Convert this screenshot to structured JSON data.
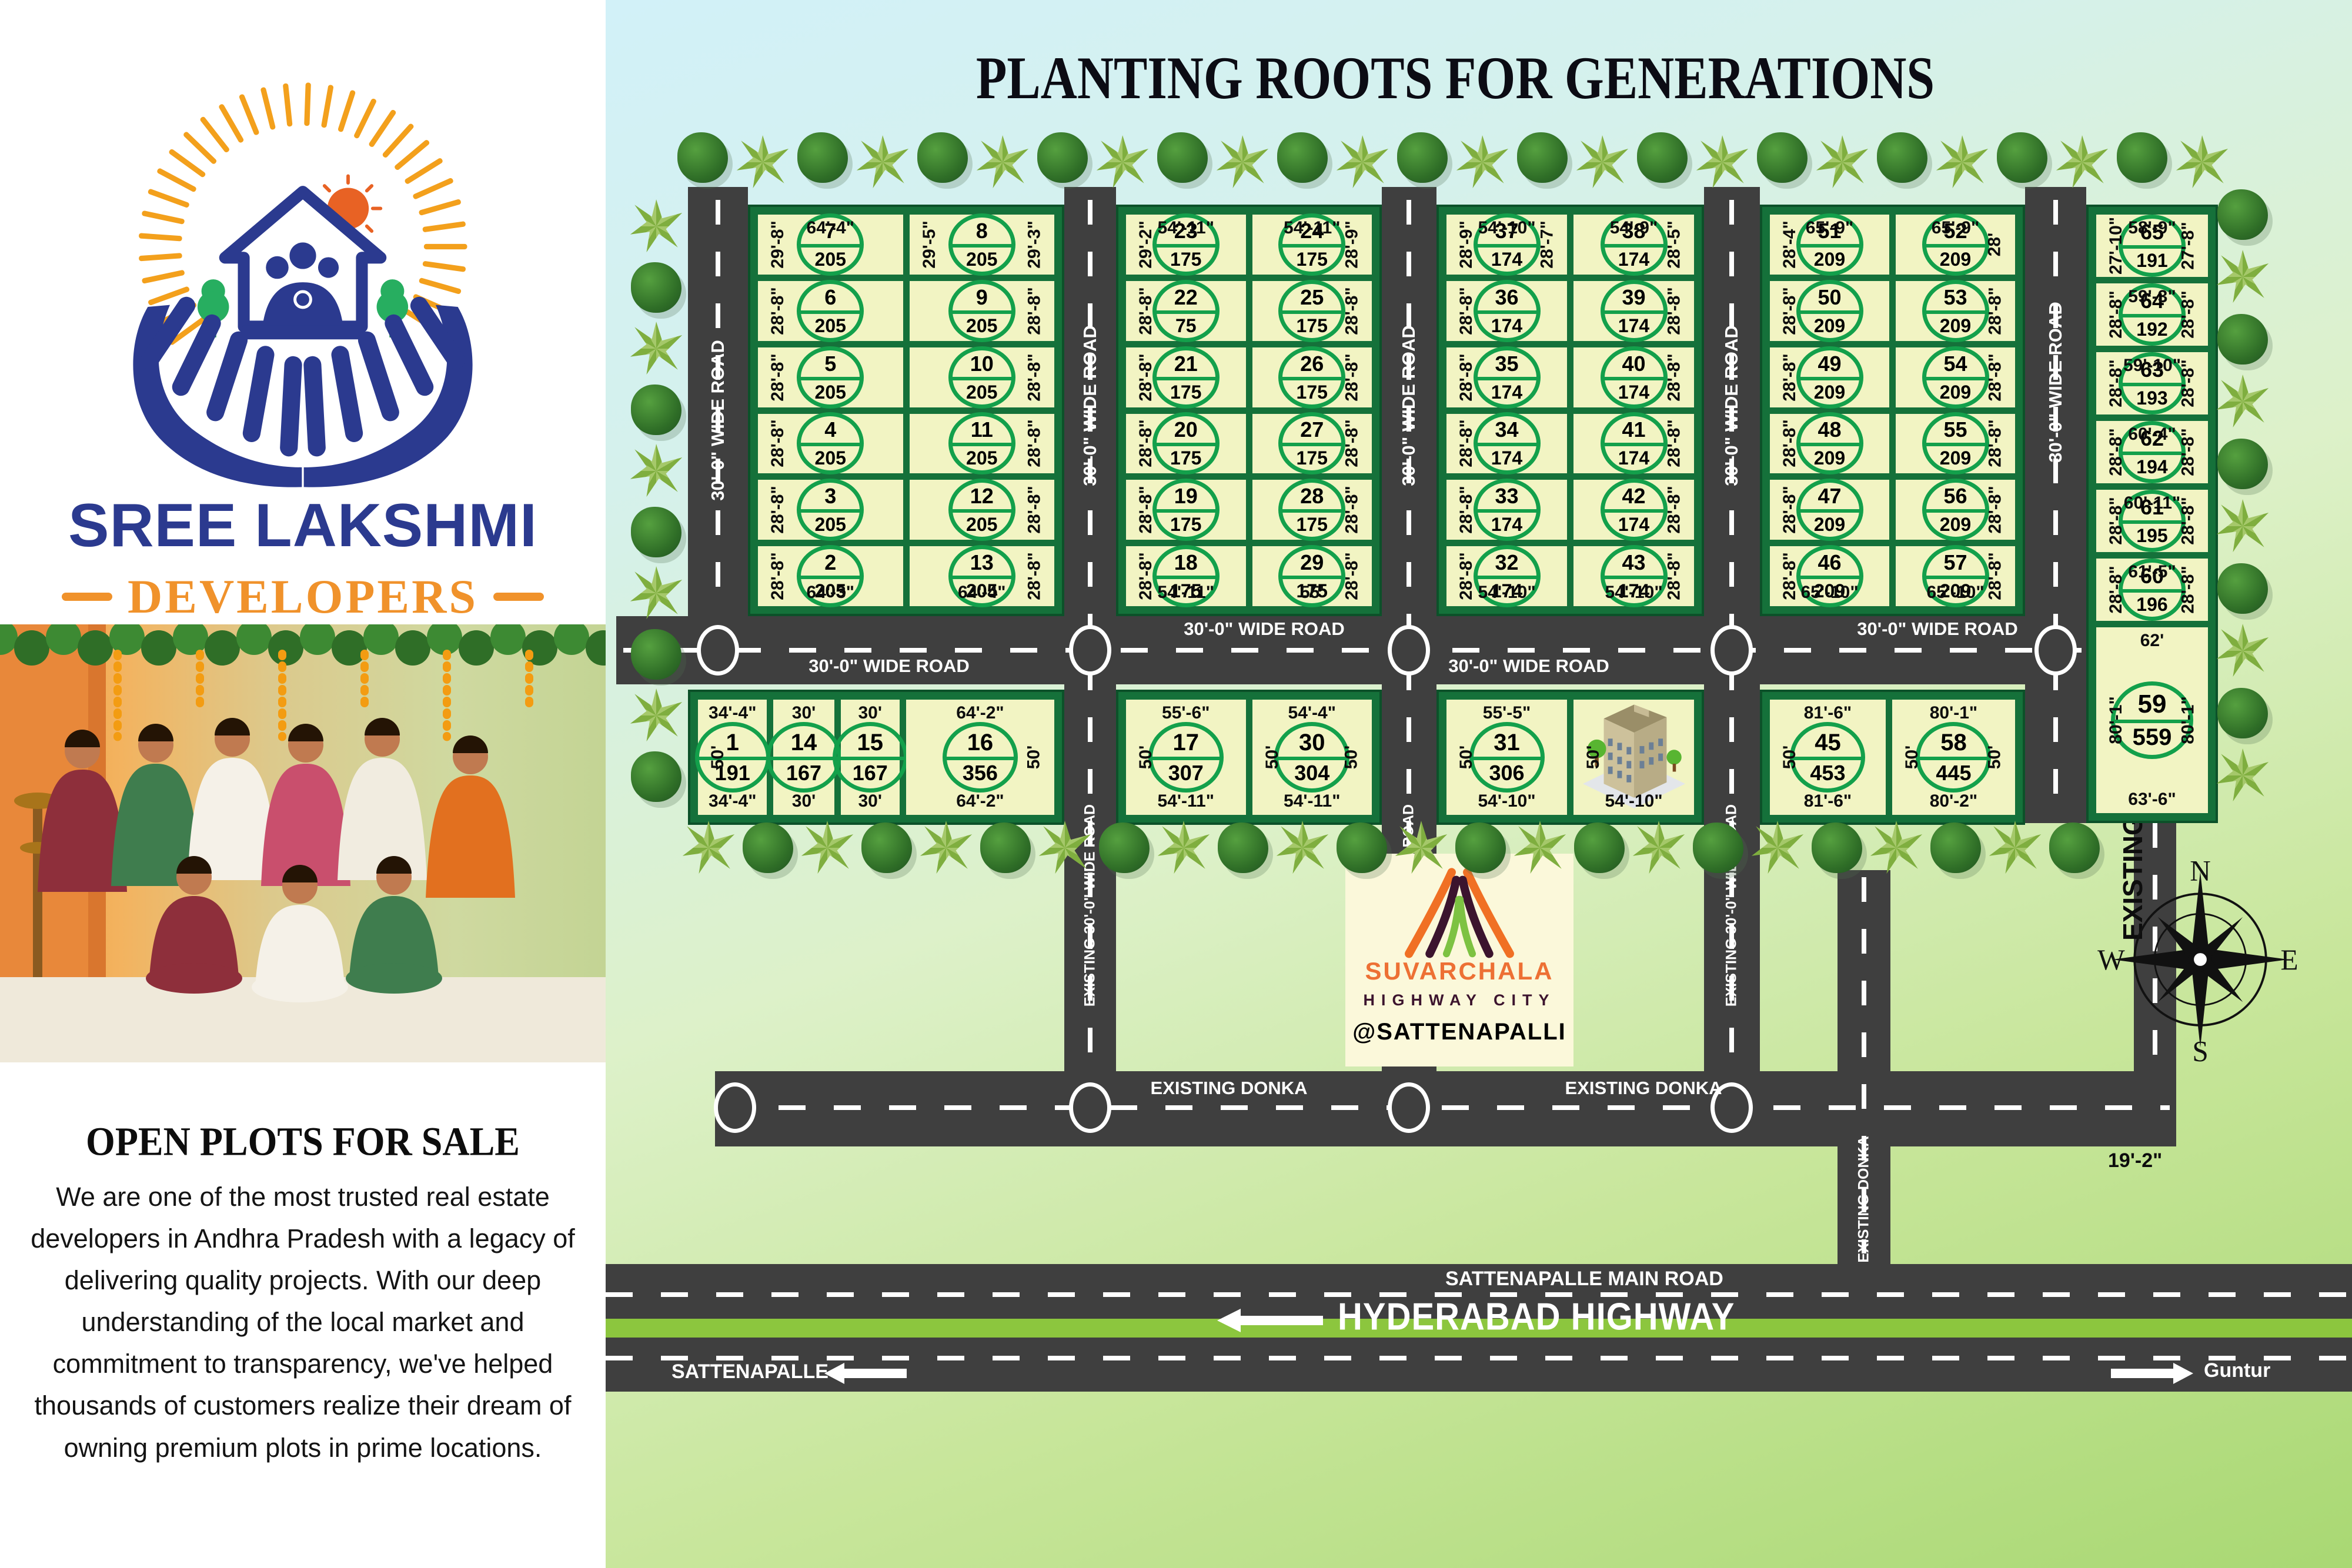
{
  "poster": {
    "title": "PLANTING ROOTS FOR GENERATIONS",
    "left_panel": {
      "brand_name": "SREE LAKSHMI",
      "brand_sub": "DEVELOPERS",
      "brand_tagline": "Planting Roots for Generations",
      "heading": "OPEN PLOTS FOR SALE",
      "paragraph": "We are one of the most trusted real estate developers in Andhra Pradesh with a legacy of delivering quality projects. With our deep understanding of the local market and commitment to transparency, we've helped thousands of customers realize their dream of owning premium plots in prime locations."
    },
    "site_card": {
      "name": "SUVARCHALA",
      "sub": "HIGHWAY CITY",
      "location": "@SATTENAPALLI"
    },
    "compass": {
      "north": "N",
      "south": "S",
      "east": "E",
      "west": "W"
    },
    "road_labels": {
      "wide_road": "30'-0\"  WIDE  ROAD",
      "existing_wide_road": "EXISTING 30'-0\" WIDE ROAD",
      "existing_donka": "EXISTING DONKA",
      "existing_houses": "EXISTING HOUSES",
      "main_road": "SATTENAPALLE MAIN ROAD",
      "highway": "HYDERABAD HIGHWAY",
      "left_city": "SATTENAPALLE",
      "right_city": "Guntur",
      "gap": "19'-2\""
    },
    "colors": {
      "road": "#3f3f3f",
      "block_border": "#15713a",
      "plot_fill": "#f2f4c3",
      "badge_green": "#13a04b",
      "highway_green": "#8cc63e",
      "brand_blue": "#2b3a8f",
      "brand_orange": "#f0922b"
    },
    "blocks": {
      "b1": {
        "plots": [
          {
            "no": "7",
            "area": "205",
            "l": "29'-8\"",
            "t": "64'-4\""
          },
          {
            "no": "8",
            "area": "205",
            "l": "29'-5\"",
            "r": "29'-3\""
          },
          {
            "no": "6",
            "area": "205",
            "l": "28'-8\""
          },
          {
            "no": "9",
            "area": "205",
            "r": "28'-8\""
          },
          {
            "no": "5",
            "area": "205",
            "l": "28'-8\""
          },
          {
            "no": "10",
            "area": "205",
            "r": "28'-8\""
          },
          {
            "no": "4",
            "area": "205",
            "l": "28'-8\""
          },
          {
            "no": "11",
            "area": "205",
            "r": "28'-8\""
          },
          {
            "no": "3",
            "area": "205",
            "l": "28'-8\""
          },
          {
            "no": "12",
            "area": "205",
            "r": "28'-8\""
          },
          {
            "no": "2",
            "area": "205",
            "l": "28'-8\"",
            "b": "64'-3\""
          },
          {
            "no": "13",
            "area": "205",
            "r": "28'-8\"",
            "b": "64'-4\""
          }
        ]
      },
      "b2": {
        "plots": [
          {
            "no": "23",
            "area": "175",
            "l": "29'-2\"",
            "t": "54'-11\""
          },
          {
            "no": "24",
            "area": "175",
            "t": "54'-11\"",
            "r": "28'-9\""
          },
          {
            "no": "22",
            "area": "75",
            "l": "28'-8\""
          },
          {
            "no": "25",
            "area": "175",
            "r": "28'-8\""
          },
          {
            "no": "21",
            "area": "175",
            "l": "28'-8\""
          },
          {
            "no": "26",
            "area": "175",
            "r": "28'-8\""
          },
          {
            "no": "20",
            "area": "175",
            "l": "28'-8\""
          },
          {
            "no": "27",
            "area": "175",
            "r": "28'-8\""
          },
          {
            "no": "19",
            "area": "175",
            "l": "28'-8\""
          },
          {
            "no": "28",
            "area": "175",
            "r": "28'-8\""
          },
          {
            "no": "18",
            "area": "175",
            "l": "28'-8\"",
            "b": "54'-11\""
          },
          {
            "no": "29",
            "area": "175",
            "b": "55'",
            "r": "28'-8\""
          }
        ]
      },
      "b3": {
        "plots": [
          {
            "no": "37",
            "area": "174",
            "l": "28'-9\"",
            "t": "54'-10\"",
            "r": "28'-7\""
          },
          {
            "no": "38",
            "area": "174",
            "t": "54'-9\"",
            "r": "28'-5\""
          },
          {
            "no": "36",
            "area": "174",
            "l": "28'-8\""
          },
          {
            "no": "39",
            "area": "174",
            "r": "28'-8\""
          },
          {
            "no": "35",
            "area": "174",
            "l": "28'-8\""
          },
          {
            "no": "40",
            "area": "174",
            "r": "28'-8\""
          },
          {
            "no": "34",
            "area": "174",
            "l": "28'-8\""
          },
          {
            "no": "41",
            "area": "174",
            "r": "28'-8\""
          },
          {
            "no": "33",
            "area": "174",
            "l": "28'-8\""
          },
          {
            "no": "42",
            "area": "174",
            "r": "28'-8\""
          },
          {
            "no": "32",
            "area": "174",
            "l": "28'-8\"",
            "b": "54'-10\""
          },
          {
            "no": "43",
            "area": "174",
            "b": "54'-10\"",
            "r": "28'-8\""
          }
        ]
      },
      "b4": {
        "plots": [
          {
            "no": "51",
            "area": "209",
            "l": "28'-4\"",
            "t": "65'-9\""
          },
          {
            "no": "52",
            "area": "209",
            "t": "65'-9\"",
            "r": "28'"
          },
          {
            "no": "50",
            "area": "209",
            "l": "28'-8\""
          },
          {
            "no": "53",
            "area": "209",
            "r": "28'-8\""
          },
          {
            "no": "49",
            "area": "209",
            "l": "28'-8\""
          },
          {
            "no": "54",
            "area": "209",
            "r": "28'-8\""
          },
          {
            "no": "48",
            "area": "209",
            "l": "28'-8\""
          },
          {
            "no": "55",
            "area": "209",
            "r": "28'-8\""
          },
          {
            "no": "47",
            "area": "209",
            "l": "28'-8\""
          },
          {
            "no": "56",
            "area": "209",
            "r": "28'-8\""
          },
          {
            "no": "46",
            "area": "209",
            "l": "28'-8\"",
            "b": "65'-10\""
          },
          {
            "no": "57",
            "area": "209",
            "b": "65'-10\"",
            "r": "28'-8\""
          }
        ]
      },
      "b5": {
        "plots": [
          {
            "no": "65",
            "area": "191",
            "l": "27'-10\"",
            "t": "58'-9\"",
            "r": "27'-8\""
          },
          {
            "no": "64",
            "area": "192",
            "l": "28'-8\"",
            "t": "59'-3\"",
            "r": "28'-8\""
          },
          {
            "no": "63",
            "area": "193",
            "l": "28'-8\"",
            "t": "59'-10\"",
            "r": "28'-8\""
          },
          {
            "no": "62",
            "area": "194",
            "l": "28'-8\"",
            "t": "60'-4\"",
            "r": "28'-8\""
          },
          {
            "no": "61",
            "area": "195",
            "l": "28'-8\"",
            "t": "60'-11\"",
            "r": "28'-8\""
          },
          {
            "no": "60",
            "area": "196",
            "l": "28'-8\"",
            "t": "61'-5\"",
            "r": "28'-8\""
          },
          {
            "no": "59",
            "area": "559",
            "t": "62'",
            "l": "80'-1\"",
            "r": "80'-1\"",
            "b": "63'-6\""
          }
        ]
      },
      "bA": {
        "plots": [
          {
            "no": "1",
            "area": "191",
            "t": "34'-4\"",
            "l": "50'",
            "b": "34'-4\""
          },
          {
            "no": "14",
            "area": "167",
            "t": "30'",
            "b": "30'"
          },
          {
            "no": "15",
            "area": "167",
            "t": "30'",
            "b": "30'"
          },
          {
            "no": "16",
            "area": "356",
            "t": "64'-2\"",
            "b": "64'-2\"",
            "r": "50'"
          }
        ]
      },
      "bB": {
        "plots": [
          {
            "no": "17",
            "area": "307",
            "t": "55'-6\"",
            "l": "50'",
            "b": "54'-11\""
          },
          {
            "no": "30",
            "area": "304",
            "t": "54'-4\"",
            "l": "50'",
            "r": "50'",
            "b": "54'-11\""
          }
        ]
      },
      "bC": {
        "plots": [
          {
            "no": "31",
            "area": "306",
            "t": "55'-5\"",
            "l": "50'",
            "b": "54'-10\""
          },
          {
            "bld": true,
            "l": "50'",
            "b": "54'-10\""
          }
        ]
      },
      "bD": {
        "plots": [
          {
            "no": "45",
            "area": "453",
            "t": "81'-6\"",
            "l": "50'",
            "b": "81'-6\""
          },
          {
            "no": "58",
            "area": "445",
            "t": "80'-1\"",
            "l": "50'",
            "r": "50'",
            "b": "80'-2\""
          }
        ]
      }
    }
  }
}
